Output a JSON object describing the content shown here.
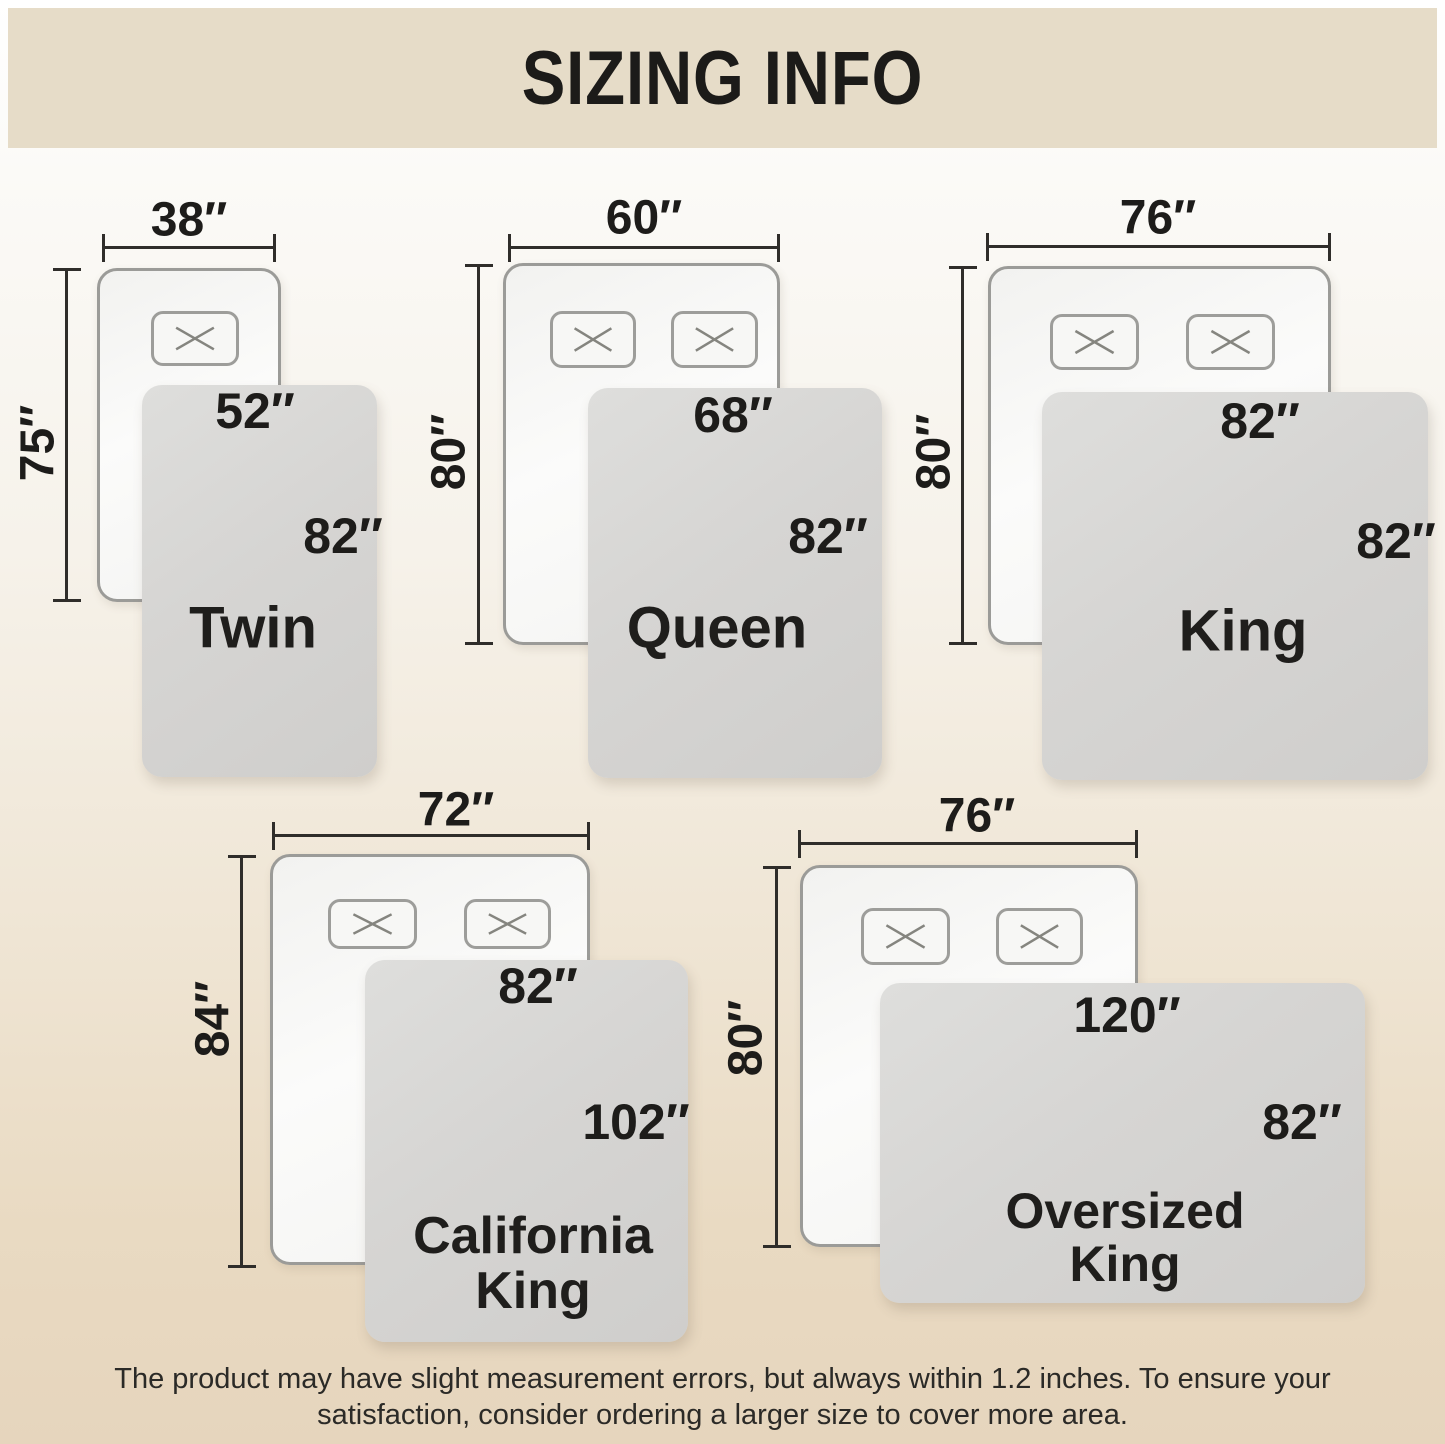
{
  "title": "SIZING INFO",
  "note": {
    "line1": "The product may have slight measurement errors, but always within 1.2 inches. To ensure your",
    "line2": "satisfaction, consider ordering a larger size to cover more area."
  },
  "beds": [
    {
      "name_lines": [
        "Twin"
      ],
      "mattress_width": "38″",
      "mattress_length": "75″",
      "blanket_width": "52″",
      "blanket_length": "82″",
      "pillows": 1
    },
    {
      "name_lines": [
        "Queen"
      ],
      "mattress_width": "60″",
      "mattress_length": "80″",
      "blanket_width": "68″",
      "blanket_length": "82″",
      "pillows": 2
    },
    {
      "name_lines": [
        "King"
      ],
      "mattress_width": "76″",
      "mattress_length": "80″",
      "blanket_width": "82″",
      "blanket_length": "82″",
      "pillows": 2
    },
    {
      "name_lines": [
        "California",
        "King"
      ],
      "mattress_width": "72″",
      "mattress_length": "84″",
      "blanket_width": "82″",
      "blanket_length": "102″",
      "pillows": 2
    },
    {
      "name_lines": [
        "Oversized",
        "King"
      ],
      "mattress_width": "76″",
      "mattress_length": "80″",
      "blanket_width": "120″",
      "blanket_length": "82″",
      "pillows": 2
    }
  ],
  "colors": {
    "banner": "#e6dcc8",
    "background_bottom": "#e6d5bd",
    "blanket": "#d6d5d3",
    "mattress": "#f7f7f5",
    "dimension_line": "#2f2d2a",
    "text": "#1d1c1a"
  }
}
